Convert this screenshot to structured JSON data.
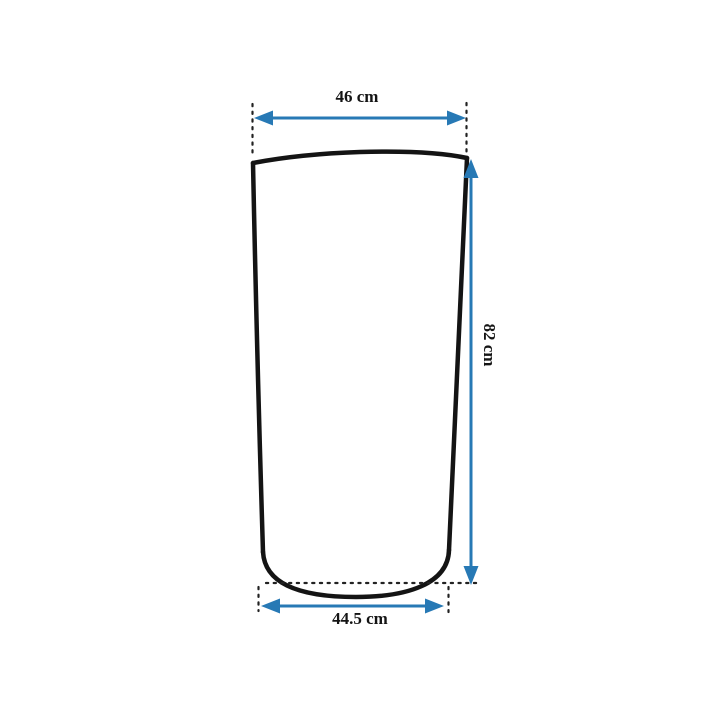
{
  "figure": {
    "description": "Outline technical drawing of a tapered container (wider at top, slightly narrower at bottom) annotated with dimension arrows",
    "background_color": "#ffffff",
    "outline_color": "#141414",
    "dimension_color": "#2779b5",
    "dimensions": {
      "top_width": {
        "label": "46 cm",
        "value": 46,
        "unit": "cm",
        "orientation": "horizontal"
      },
      "height": {
        "label": "82 cm",
        "value": 82,
        "unit": "cm",
        "orientation": "vertical"
      },
      "bottom_width": {
        "label": "44.5 cm",
        "value": 44.5,
        "unit": "cm",
        "orientation": "horizontal"
      }
    }
  }
}
